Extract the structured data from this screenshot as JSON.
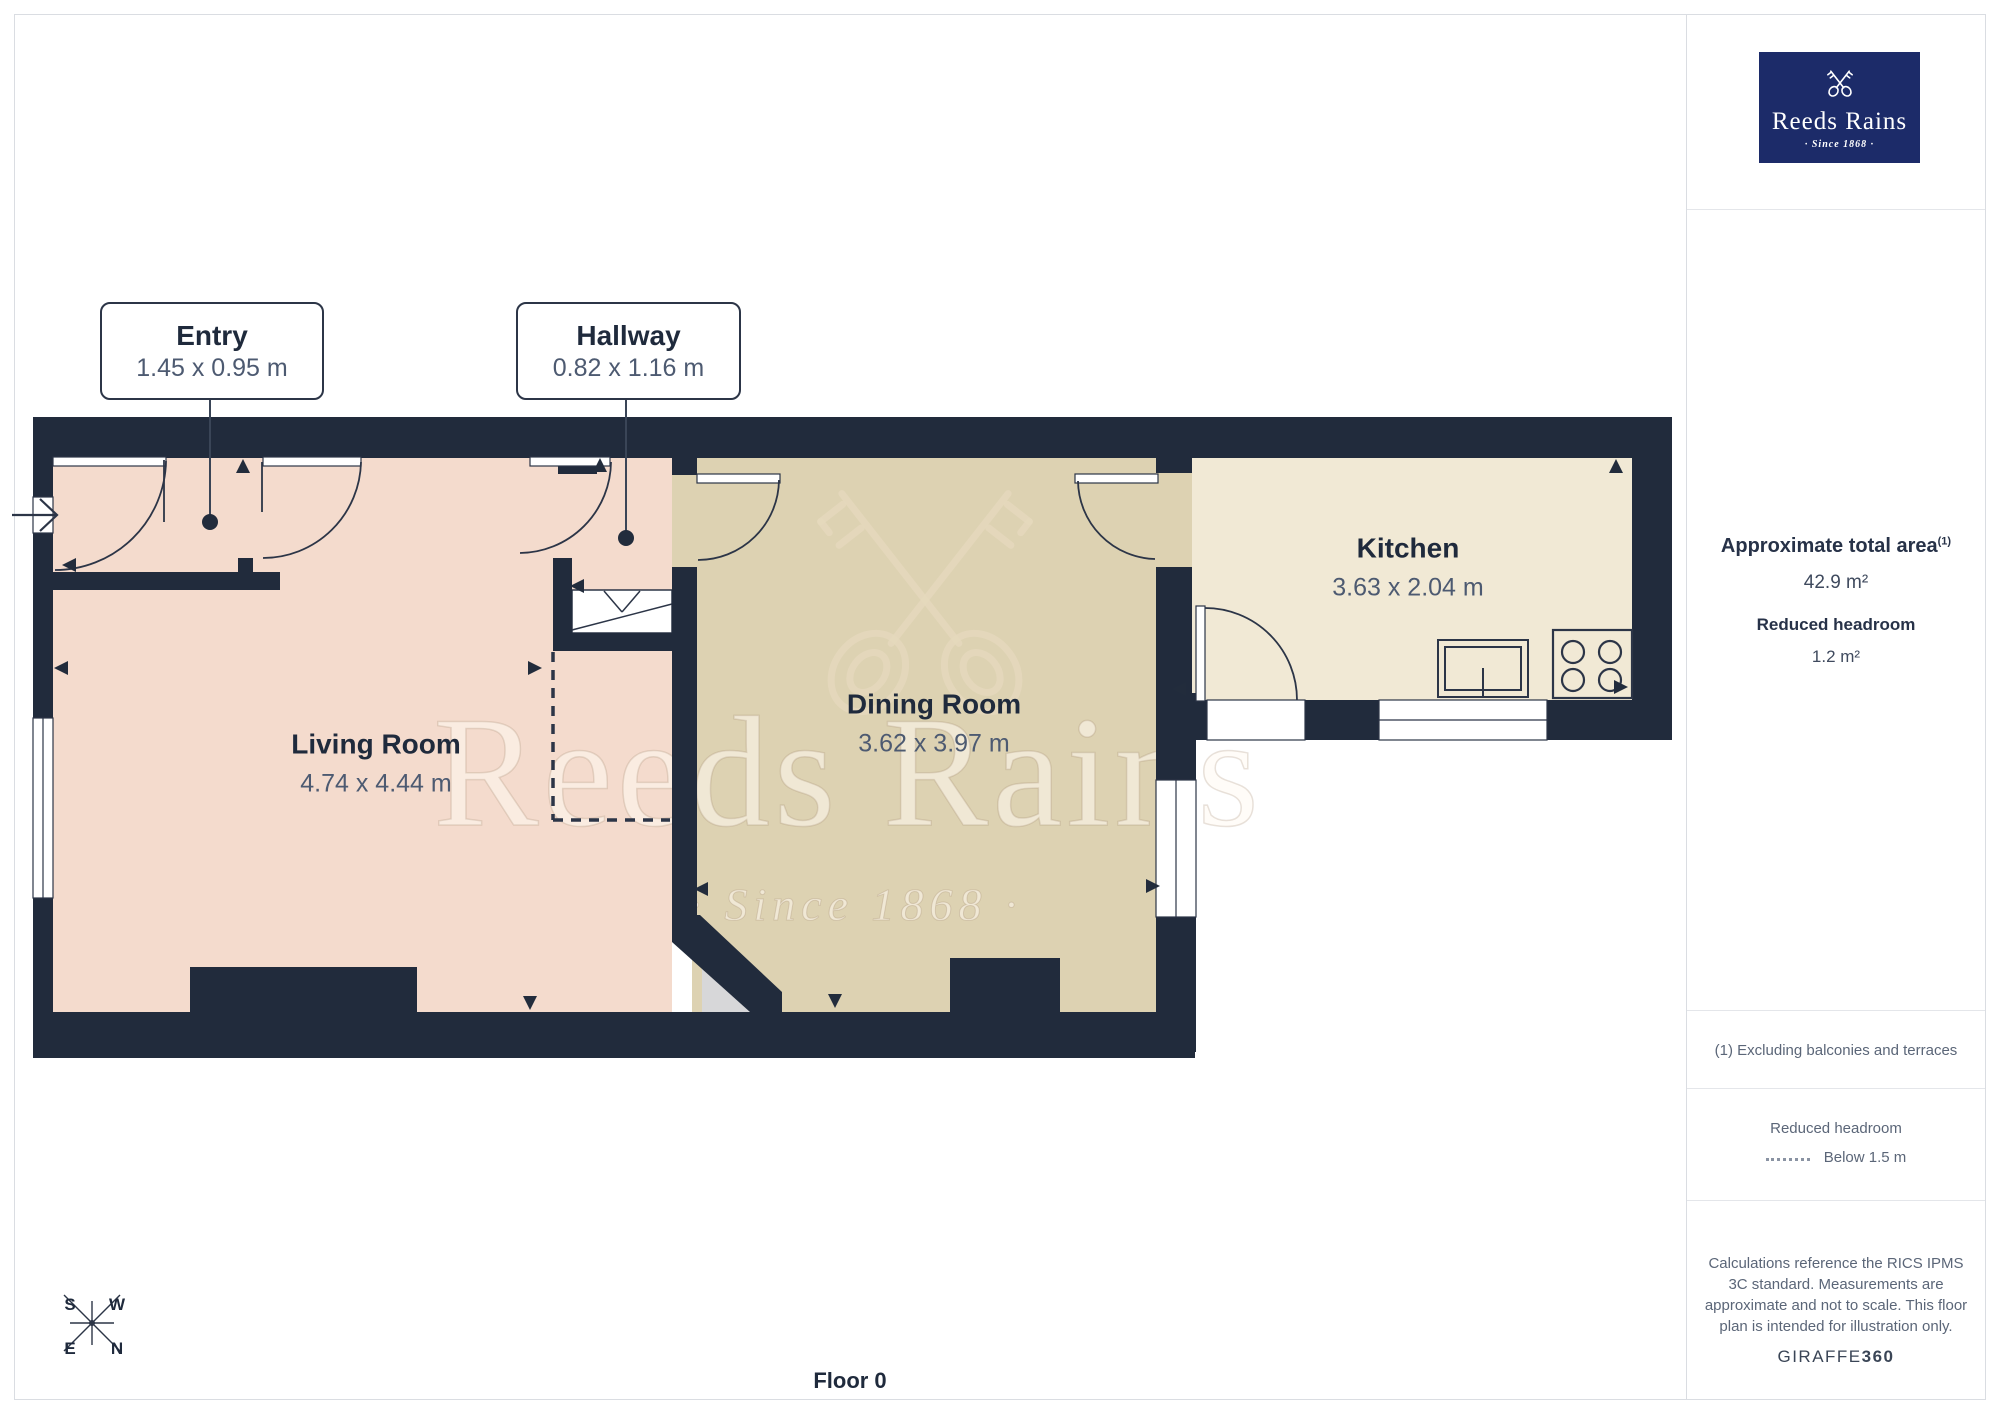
{
  "branding": {
    "logo_title": "Reeds Rains",
    "logo_tagline": "· Since 1868 ·",
    "logo_bg_color": "#1c2b69"
  },
  "watermark": {
    "title": "Reeds Rains",
    "tagline": "· Since 1868 ·"
  },
  "floorplan": {
    "callouts": [
      {
        "name": "Entry",
        "dims": "1.45 x 0.95 m"
      },
      {
        "name": "Hallway",
        "dims": "0.82 x 1.16 m"
      }
    ],
    "rooms": [
      {
        "name": "Living Room",
        "dims": "4.74 x 4.44 m"
      },
      {
        "name": "Dining Room",
        "dims": "3.62 x 3.97 m"
      },
      {
        "name": "Kitchen",
        "dims": "3.63 x 2.04 m"
      }
    ],
    "colors": {
      "wall": "#212b3c",
      "living_floor": "#f4dbcd",
      "dining_floor": "#ddd2b2",
      "kitchen_floor": "#f1e9d5",
      "understair": "#d7d7d9"
    }
  },
  "compass": {
    "n": "N",
    "s": "S",
    "e": "E",
    "w": "W"
  },
  "footer": {
    "floor_label": "Floor 0"
  },
  "sidebar": {
    "area_heading": "Approximate total area",
    "area_heading_sup": "(1)",
    "area_value": "42.9 m²",
    "headroom_heading": "Reduced headroom",
    "headroom_value": "1.2 m²",
    "footnote": "(1) Excluding balconies and terraces",
    "legend_heading": "Reduced headroom",
    "legend_label": "Below 1.5 m",
    "disclaimer": "Calculations reference the RICS IPMS 3C standard. Measurements are approximate and not to scale. This floor plan is intended for illustration only.",
    "brand_name": "GIRAFFE",
    "brand_number": "360"
  }
}
